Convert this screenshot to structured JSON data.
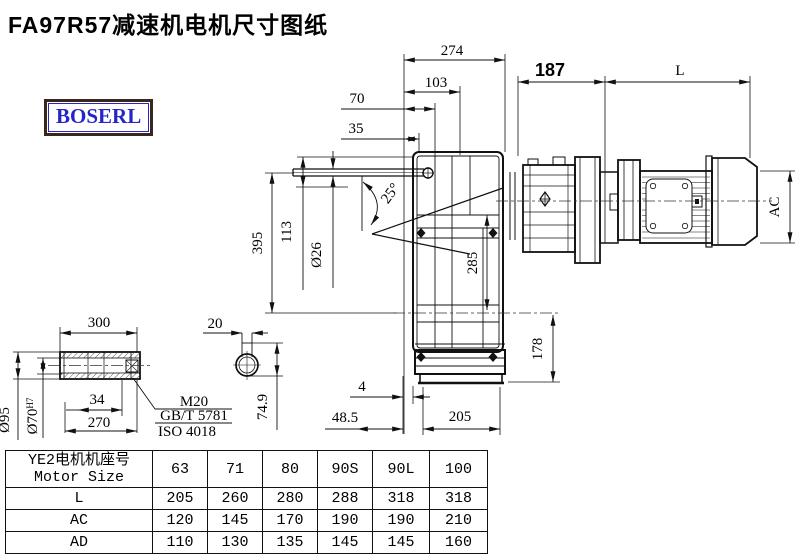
{
  "header": {
    "title": "FA97R57减速机电机尺寸图纸",
    "logo": "BOSERL"
  },
  "drawing": {
    "dims": {
      "w274": "274",
      "w103": "103",
      "w70": "70",
      "w35": "35",
      "w187": "187",
      "len_l": "L",
      "ac": "AC",
      "h395": "395",
      "h113": "113",
      "dia26": "Ø26",
      "angle25": "25°",
      "h285": "285",
      "h178": "178",
      "gap4": "4",
      "off485": "48.5",
      "w205": "205",
      "s300": "300",
      "key20": "20",
      "dia95": "Ø95",
      "dia70": "Ø70",
      "dia70sup": "H7",
      "d34": "34",
      "l270": "270",
      "kh749": "74.9",
      "thread": "M20",
      "std1": "GB/T 5781",
      "std2": "ISO 4018"
    },
    "colors": {
      "line": "#111111",
      "logo_blue": "#2525c8",
      "logo_border": "#3a261c"
    }
  },
  "table": {
    "header_cn": "YE2电机机座号",
    "header_en": "Motor Size",
    "sizes": [
      "63",
      "71",
      "80",
      "90S",
      "90L",
      "100"
    ],
    "rows": [
      {
        "label": "L",
        "values": [
          "205",
          "260",
          "280",
          "288",
          "318",
          "318"
        ]
      },
      {
        "label": "AC",
        "values": [
          "120",
          "145",
          "170",
          "190",
          "190",
          "210"
        ]
      },
      {
        "label": "AD",
        "values": [
          "110",
          "130",
          "135",
          "145",
          "145",
          "160"
        ]
      }
    ]
  }
}
